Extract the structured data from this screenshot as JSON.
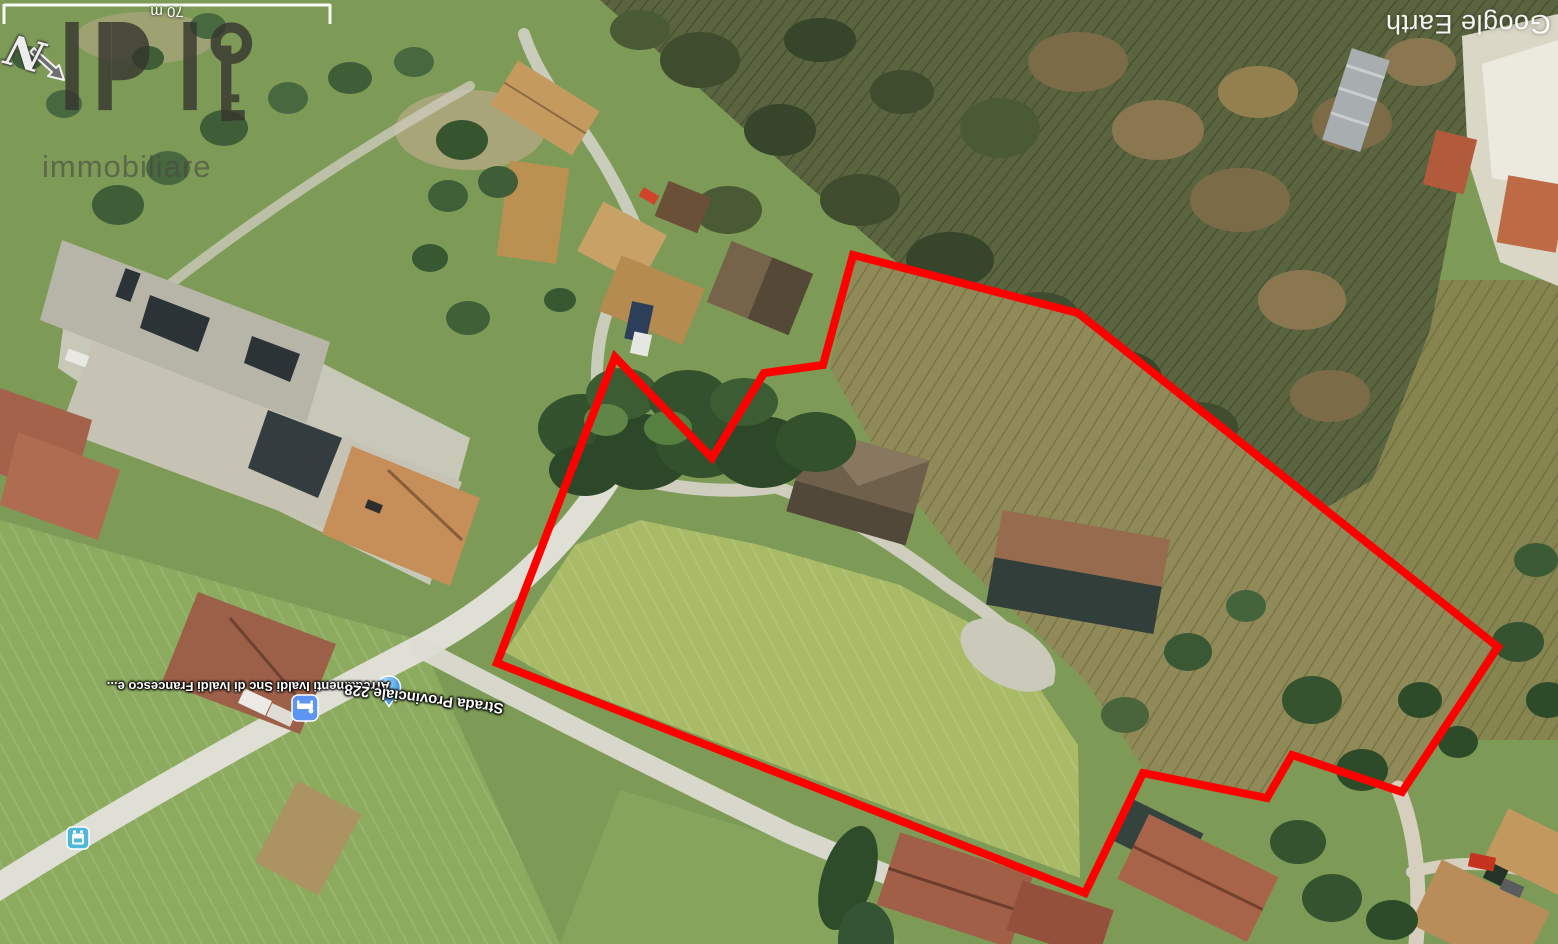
{
  "map": {
    "provider_watermark": "Google Earth",
    "scale_bar": {
      "label": "70 m"
    },
    "compass": {
      "label": "N"
    },
    "logo": {
      "brand": "IPI",
      "subtitle": "immobiliare"
    },
    "labels": {
      "business": "Arredamenti Ivaldi Snc di Ivaldi Francesco e...",
      "road": "Strada Provinciale 228"
    },
    "markers": [
      {
        "name": "poi-drop-marker",
        "type": "place-drop",
        "color": "#5ba8e8"
      },
      {
        "name": "furniture-poi-icon",
        "type": "furniture-store",
        "color": "#5d96f2"
      },
      {
        "name": "bus-stop-icon",
        "type": "bus-stop",
        "color": "#4fb8d9"
      }
    ],
    "boundary": {
      "color": "#ff0000",
      "stroke_width": 8,
      "points": "853,255 1078,313 1498,647 1402,792 1292,755 1267,798 1143,773 1085,893 497,663 615,357 712,458 764,373 823,365"
    },
    "colors": {
      "boundary_red": "#ff0000",
      "label_white": "#ffffff",
      "logo_gray": "#35352e"
    }
  }
}
